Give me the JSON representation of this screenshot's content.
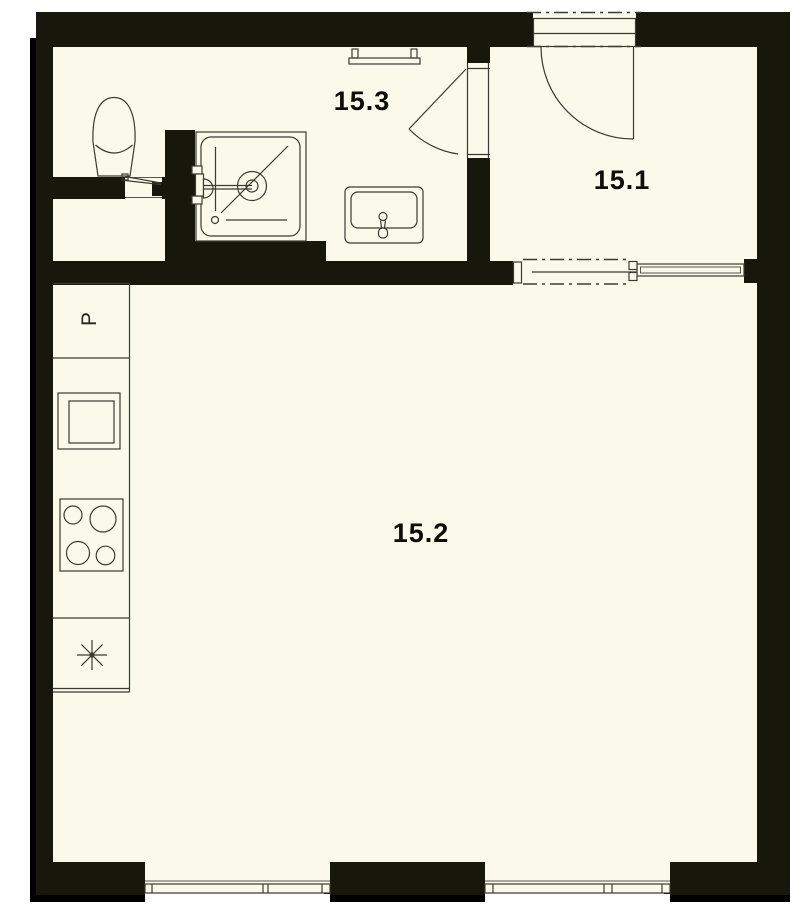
{
  "document_type": "apartment floor plan",
  "rooms": {
    "hall": {
      "label": "15.1"
    },
    "living_kitchen": {
      "label": "15.2"
    },
    "bathroom": {
      "label": "15.3"
    }
  },
  "kitchen": {
    "appliance_label": "P"
  },
  "colors": {
    "paper": "#FAF9EA",
    "wall": "#17170C",
    "shadow": "#000000",
    "line": "#3B3B33",
    "label_text": "#0D0D0A",
    "page_background": "#FFFFFF"
  },
  "fixtures": {
    "bathroom": [
      "toilet",
      "shower-tray",
      "shower-mixer",
      "washbasin",
      "towel-rail"
    ],
    "kitchen": [
      "fridge",
      "oven",
      "hob-four-burners",
      "kitchen-sink"
    ],
    "doors": [
      "entrance-swing-door",
      "bathroom-swing-door",
      "closet-flap-door",
      "pocket-sliding-door"
    ],
    "windows": [
      "window-left",
      "window-right"
    ]
  }
}
